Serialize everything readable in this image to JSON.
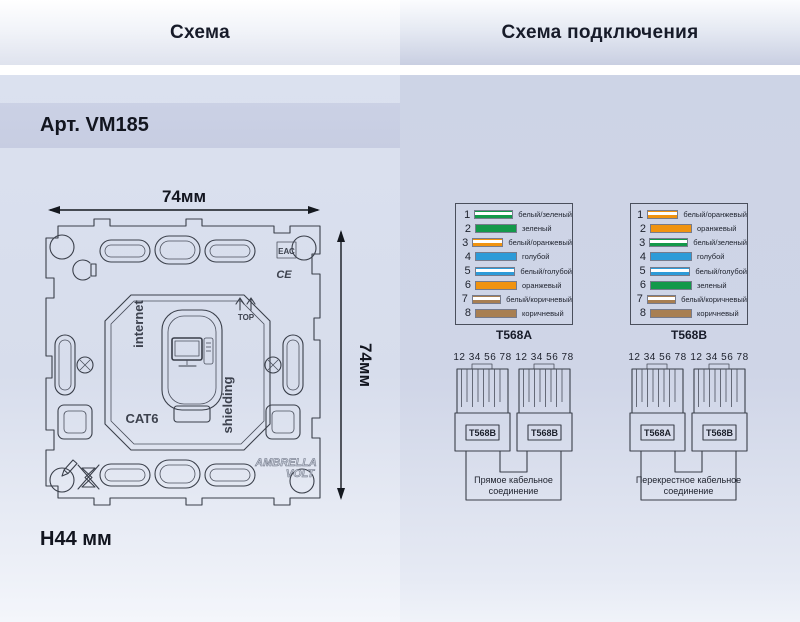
{
  "header": {
    "left_title": "Схема",
    "right_title": "Схема подключения"
  },
  "left_panel": {
    "article": "Арт. VM185",
    "dimensions": {
      "width_label": "74мм",
      "height_label": "74мм",
      "depth_label": "Н44 мм"
    },
    "drawing_labels": {
      "internet": "internet",
      "shielding": "shielding",
      "cat6": "CAT6",
      "top": "TOP",
      "eac": "ЕАС",
      "ce": "CE",
      "brand_line1": "AMBRELLA",
      "brand_line2": "VOLT"
    }
  },
  "right_panel": {
    "wire_colors": {
      "green": "#13994a",
      "orange": "#f09310",
      "blue": "#2d9bd8",
      "brown": "#a87f52"
    },
    "pinout_tables": [
      {
        "caption": "T568A",
        "rows": [
          {
            "num": "1",
            "label": "белый/зеленый",
            "color": "#13994a",
            "striped": true
          },
          {
            "num": "2",
            "label": "зеленый",
            "color": "#13994a",
            "striped": false
          },
          {
            "num": "3",
            "label": "белый/оранжевый",
            "color": "#f09310",
            "striped": true
          },
          {
            "num": "4",
            "label": "голубой",
            "color": "#2d9bd8",
            "striped": false
          },
          {
            "num": "5",
            "label": "белый/голубой",
            "color": "#2d9bd8",
            "striped": true
          },
          {
            "num": "6",
            "label": "оранжевый",
            "color": "#f09310",
            "striped": false
          },
          {
            "num": "7",
            "label": "белый/коричневый",
            "color": "#a87f52",
            "striped": true
          },
          {
            "num": "8",
            "label": "коричневый",
            "color": "#a87f52",
            "striped": false
          }
        ]
      },
      {
        "caption": "T568B",
        "rows": [
          {
            "num": "1",
            "label": "белый/оранжевый",
            "color": "#f09310",
            "striped": true
          },
          {
            "num": "2",
            "label": "оранжевый",
            "color": "#f09310",
            "striped": false
          },
          {
            "num": "3",
            "label": "белый/зеленый",
            "color": "#13994a",
            "striped": true
          },
          {
            "num": "4",
            "label": "голубой",
            "color": "#2d9bd8",
            "striped": false
          },
          {
            "num": "5",
            "label": "белый/голубой",
            "color": "#2d9bd8",
            "striped": true
          },
          {
            "num": "6",
            "label": "зеленый",
            "color": "#13994a",
            "striped": false
          },
          {
            "num": "7",
            "label": "белый/коричневый",
            "color": "#a87f52",
            "striped": true
          },
          {
            "num": "8",
            "label": "коричневый",
            "color": "#a87f52",
            "striped": false
          }
        ]
      }
    ],
    "cable_diagrams": [
      {
        "pin_numbers": "12 34 56 78",
        "left_connector": "T568B",
        "right_connector": "T568B",
        "caption": "Прямое кабельное соединение"
      },
      {
        "pin_numbers": "12 34 56 78",
        "left_connector": "T568A",
        "right_connector": "T568B",
        "caption": "Перекрестное кабельное соединение"
      }
    ]
  }
}
